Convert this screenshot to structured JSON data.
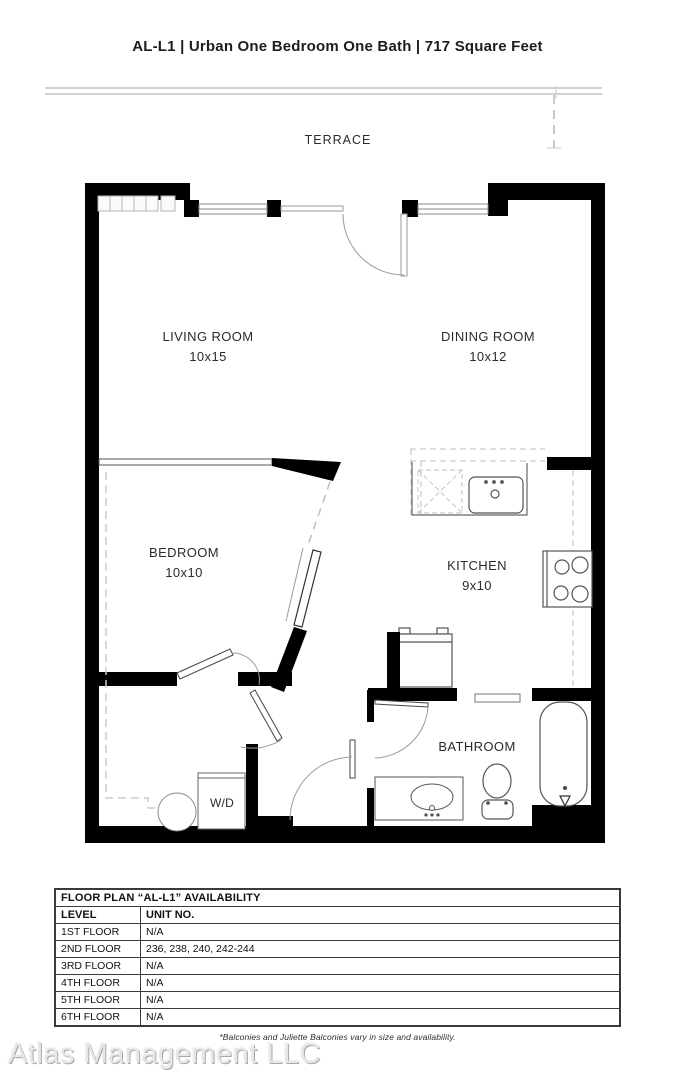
{
  "header": {
    "title": "AL-L1 | Urban One Bedroom One Bath | 717 Square Feet"
  },
  "plan": {
    "terrace": "TERRACE",
    "living": {
      "name": "LIVING ROOM",
      "dims": "10x15"
    },
    "dining": {
      "name": "DINING ROOM",
      "dims": "10x12"
    },
    "bedroom": {
      "name": "BEDROOM",
      "dims": "10x10"
    },
    "kitchen": {
      "name": "KITCHEN",
      "dims": "9x10"
    },
    "bathroom": {
      "name": "BATHROOM"
    },
    "washer_dryer": {
      "name": "W/D"
    }
  },
  "availability_table": {
    "title": "FLOOR PLAN “AL-L1” AVAILABILITY",
    "columns": [
      "LEVEL",
      "UNIT NO."
    ],
    "rows": [
      {
        "level": "1ST FLOOR",
        "units": "N/A"
      },
      {
        "level": "2ND FLOOR",
        "units": "236, 238, 240, 242-244"
      },
      {
        "level": "3RD FLOOR",
        "units": "N/A"
      },
      {
        "level": "4TH FLOOR",
        "units": "N/A"
      },
      {
        "level": "5TH FLOOR",
        "units": "N/A"
      },
      {
        "level": "6TH FLOOR",
        "units": "N/A"
      }
    ]
  },
  "footer": {
    "note": "*Balconies and Juliette Balconies vary in size and availability.",
    "watermark": "Atlas Management LLC"
  },
  "colors": {
    "wall": "#000000",
    "fixture_line": "#555555",
    "light_line": "#c4c4c4",
    "watermark": "#e6e6e6"
  }
}
